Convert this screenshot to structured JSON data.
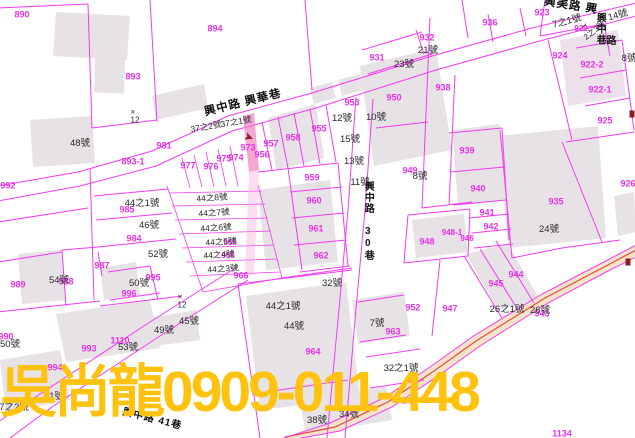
{
  "title": "cadastral-parcel-map",
  "colors": {
    "background": "#ffffff",
    "parcel_line": "#f23cf2",
    "building_fill": "#e7e2e6",
    "building_pink_fill": "#ece0ea",
    "road_fill_beige": "#f5e4c8",
    "road_centerline": "#e04b4b",
    "highlight_parcel": "#f07ec0",
    "pink_label": "#e832e8",
    "black_label": "#2a2a2a",
    "watermark_yellow": "#ffc20e",
    "marker_red": "#8f1d1d"
  },
  "watermark": {
    "text": "吳尚龍0909-011-448"
  },
  "map": {
    "road_names": [
      "興中路 興華巷",
      "興美路",
      "興中路 30巷",
      "興中路 41巷",
      "興中巷"
    ],
    "labels": [
      {
        "t": "890",
        "x": 22,
        "y": 15,
        "c": "pink"
      },
      {
        "t": "894",
        "x": 215,
        "y": 29,
        "c": "pink"
      },
      {
        "t": "893",
        "x": 133,
        "y": 77,
        "c": "pink"
      },
      {
        "t": "981",
        "x": 164,
        "y": 146,
        "c": "pink"
      },
      {
        "t": "893-1",
        "x": 133,
        "y": 162,
        "c": "pink"
      },
      {
        "t": "992",
        "x": 8,
        "y": 186,
        "c": "pink"
      },
      {
        "t": "977",
        "x": 188,
        "y": 166,
        "c": "pink"
      },
      {
        "t": "976",
        "x": 211,
        "y": 167,
        "c": "pink"
      },
      {
        "t": "975",
        "x": 224,
        "y": 159,
        "c": "pink"
      },
      {
        "t": "974",
        "x": 236,
        "y": 158,
        "c": "pink"
      },
      {
        "t": "973",
        "x": 248,
        "y": 148,
        "c": "pink"
      },
      {
        "t": "956",
        "x": 262,
        "y": 155,
        "c": "pink"
      },
      {
        "t": "957",
        "x": 271,
        "y": 144,
        "c": "pink"
      },
      {
        "t": "958",
        "x": 293,
        "y": 138,
        "c": "pink"
      },
      {
        "t": "955",
        "x": 319,
        "y": 129,
        "c": "pink"
      },
      {
        "t": "953",
        "x": 352,
        "y": 103,
        "c": "pink"
      },
      {
        "t": "959",
        "x": 312,
        "y": 178,
        "c": "pink"
      },
      {
        "t": "960",
        "x": 314,
        "y": 201,
        "c": "pink"
      },
      {
        "t": "961",
        "x": 316,
        "y": 229,
        "c": "pink"
      },
      {
        "t": "962",
        "x": 321,
        "y": 256,
        "c": "pink"
      },
      {
        "t": "966",
        "x": 241,
        "y": 276,
        "c": "pink"
      },
      {
        "t": "969",
        "x": 230,
        "y": 243,
        "c": "pink",
        "s": 8
      },
      {
        "t": "968",
        "x": 228,
        "y": 256,
        "c": "pink",
        "s": 8
      },
      {
        "t": "950",
        "x": 394,
        "y": 98,
        "c": "pink"
      },
      {
        "t": "938",
        "x": 443,
        "y": 88,
        "c": "pink"
      },
      {
        "t": "939",
        "x": 467,
        "y": 151,
        "c": "pink"
      },
      {
        "t": "949",
        "x": 410,
        "y": 171,
        "c": "pink"
      },
      {
        "t": "940",
        "x": 478,
        "y": 189,
        "c": "pink"
      },
      {
        "t": "941",
        "x": 487,
        "y": 213,
        "c": "pink"
      },
      {
        "t": "942",
        "x": 491,
        "y": 227,
        "c": "pink"
      },
      {
        "t": "948-1",
        "x": 452,
        "y": 233,
        "c": "pink",
        "s": 8
      },
      {
        "t": "946",
        "x": 467,
        "y": 239,
        "c": "pink",
        "s": 8
      },
      {
        "t": "948",
        "x": 427,
        "y": 242,
        "c": "pink"
      },
      {
        "t": "947",
        "x": 450,
        "y": 309,
        "c": "pink"
      },
      {
        "t": "945",
        "x": 496,
        "y": 284,
        "c": "pink"
      },
      {
        "t": "944",
        "x": 516,
        "y": 275,
        "c": "pink"
      },
      {
        "t": "943",
        "x": 542,
        "y": 314,
        "c": "pink"
      },
      {
        "t": "952",
        "x": 413,
        "y": 308,
        "c": "pink"
      },
      {
        "t": "963",
        "x": 393,
        "y": 332,
        "c": "pink"
      },
      {
        "t": "964",
        "x": 313,
        "y": 352,
        "c": "pink"
      },
      {
        "t": "935",
        "x": 556,
        "y": 202,
        "c": "pink"
      },
      {
        "t": "936",
        "x": 490,
        "y": 23,
        "c": "pink"
      },
      {
        "t": "932",
        "x": 427,
        "y": 38,
        "c": "pink"
      },
      {
        "t": "931",
        "x": 377,
        "y": 58,
        "c": "pink"
      },
      {
        "t": "923",
        "x": 542,
        "y": 13,
        "c": "pink"
      },
      {
        "t": "922",
        "x": 581,
        "y": 29,
        "c": "pink",
        "s": 8
      },
      {
        "t": "924",
        "x": 560,
        "y": 56,
        "c": "pink"
      },
      {
        "t": "922-2",
        "x": 592,
        "y": 65,
        "c": "pink"
      },
      {
        "t": "922-1",
        "x": 600,
        "y": 90,
        "c": "pink"
      },
      {
        "t": "925",
        "x": 605,
        "y": 121,
        "c": "pink"
      },
      {
        "t": "926",
        "x": 628,
        "y": 184,
        "c": "pink"
      },
      {
        "t": "984",
        "x": 134,
        "y": 239,
        "c": "pink"
      },
      {
        "t": "985",
        "x": 127,
        "y": 210,
        "c": "pink"
      },
      {
        "t": "987",
        "x": 102,
        "y": 266,
        "c": "pink"
      },
      {
        "t": "988",
        "x": 66,
        "y": 282,
        "c": "pink"
      },
      {
        "t": "989",
        "x": 18,
        "y": 285,
        "c": "pink"
      },
      {
        "t": "990",
        "x": 6,
        "y": 337,
        "c": "pink"
      },
      {
        "t": "993",
        "x": 89,
        "y": 349,
        "c": "pink"
      },
      {
        "t": "994",
        "x": 55,
        "y": 368,
        "c": "pink"
      },
      {
        "t": "995",
        "x": 153,
        "y": 278,
        "c": "pink"
      },
      {
        "t": "996",
        "x": 129,
        "y": 294,
        "c": "pink"
      },
      {
        "t": "1110",
        "x": 120,
        "y": 341,
        "c": "pink"
      },
      {
        "t": "1134",
        "x": 562,
        "y": 434,
        "c": "pink"
      },
      {
        "t": "24",
        "x": 407,
        "y": 401,
        "c": "pink"
      },
      {
        "t": "48號",
        "x": 80,
        "y": 144,
        "c": "blk"
      },
      {
        "t": "×\n12",
        "x": 135,
        "y": 117,
        "c": "blk",
        "s": 8
      },
      {
        "t": "×\n12",
        "x": 182,
        "y": 302,
        "c": "blk",
        "s": 8
      },
      {
        "t": "37之2號",
        "x": 206,
        "y": 127,
        "c": "blk",
        "r": -10,
        "s": 8.5
      },
      {
        "t": "37之1號",
        "x": 236,
        "y": 122,
        "c": "blk",
        "r": -10,
        "s": 8.5
      },
      {
        "t": "21號",
        "x": 428,
        "y": 51,
        "c": "blk"
      },
      {
        "t": "23號",
        "x": 404,
        "y": 65,
        "c": "blk"
      },
      {
        "t": "7之1號",
        "x": 567,
        "y": 22,
        "c": "blk",
        "r": -15
      },
      {
        "t": "~",
        "x": 584,
        "y": 26,
        "c": "blk",
        "r": -50,
        "s": 12
      },
      {
        "t": "14號",
        "x": 618,
        "y": 16,
        "c": "blk",
        "r": -15
      },
      {
        "t": "2之3號",
        "x": 595,
        "y": 31,
        "c": "blk",
        "r": -38,
        "s": 8
      },
      {
        "t": "8號",
        "x": 629,
        "y": 59,
        "c": "blk"
      },
      {
        "t": "12號",
        "x": 342,
        "y": 119,
        "c": "blk"
      },
      {
        "t": "10號",
        "x": 376,
        "y": 118,
        "c": "blk"
      },
      {
        "t": "15號",
        "x": 350,
        "y": 140,
        "c": "blk"
      },
      {
        "t": "13號",
        "x": 354,
        "y": 162,
        "c": "blk"
      },
      {
        "t": "11號",
        "x": 360,
        "y": 183,
        "c": "blk"
      },
      {
        "t": "8號",
        "x": 420,
        "y": 177,
        "c": "blk"
      },
      {
        "t": "24號",
        "x": 549,
        "y": 230,
        "c": "blk"
      },
      {
        "t": "44之8號",
        "x": 212,
        "y": 198,
        "c": "blk",
        "r": -4,
        "s": 8.5
      },
      {
        "t": "44之7號",
        "x": 214,
        "y": 213,
        "c": "blk",
        "r": -4,
        "s": 8.5
      },
      {
        "t": "44之6號",
        "x": 216,
        "y": 228,
        "c": "blk",
        "r": -4,
        "s": 8.5
      },
      {
        "t": "44之5號",
        "x": 221,
        "y": 242,
        "c": "blk",
        "r": -4,
        "s": 8.5
      },
      {
        "t": "44之4號",
        "x": 219,
        "y": 255,
        "c": "blk",
        "r": -4,
        "s": 8.5
      },
      {
        "t": "44之3號",
        "x": 223,
        "y": 269,
        "c": "blk",
        "r": -4,
        "s": 8.5
      },
      {
        "t": "44之1號",
        "x": 142,
        "y": 204,
        "c": "blk"
      },
      {
        "t": "46號",
        "x": 149,
        "y": 226,
        "c": "blk"
      },
      {
        "t": "52號",
        "x": 158,
        "y": 255,
        "c": "blk"
      },
      {
        "t": "54號",
        "x": 59,
        "y": 281,
        "c": "blk"
      },
      {
        "t": "50號",
        "x": 139,
        "y": 284,
        "c": "blk"
      },
      {
        "t": "50號",
        "x": 10,
        "y": 345,
        "c": "blk"
      },
      {
        "t": "53號",
        "x": 128,
        "y": 348,
        "c": "blk"
      },
      {
        "t": "49號",
        "x": 164,
        "y": 331,
        "c": "blk"
      },
      {
        "t": "45號",
        "x": 189,
        "y": 322,
        "c": "blk"
      },
      {
        "t": "51號",
        "x": 54,
        "y": 397,
        "c": "blk"
      },
      {
        "t": "7之2號",
        "x": 14,
        "y": 408,
        "c": "blk"
      },
      {
        "t": "44之1號",
        "x": 283,
        "y": 307,
        "c": "blk"
      },
      {
        "t": "44號",
        "x": 294,
        "y": 327,
        "c": "blk"
      },
      {
        "t": "32號",
        "x": 332,
        "y": 284,
        "c": "blk"
      },
      {
        "t": "7號",
        "x": 377,
        "y": 324,
        "c": "blk"
      },
      {
        "t": "32之1號",
        "x": 401,
        "y": 369,
        "c": "blk"
      },
      {
        "t": "38號",
        "x": 317,
        "y": 421,
        "c": "blk"
      },
      {
        "t": "34號",
        "x": 349,
        "y": 415,
        "c": "blk"
      },
      {
        "t": "26之1號",
        "x": 507,
        "y": 310,
        "c": "blk"
      },
      {
        "t": "26號",
        "x": 540,
        "y": 311,
        "c": "blk"
      },
      {
        "t": "興中路 興華巷",
        "x": 243,
        "y": 103,
        "c": "road",
        "r": -14
      },
      {
        "t": "興美路 興",
        "x": 571,
        "y": 6,
        "c": "road",
        "r": 9
      },
      {
        "t": "興中巷",
        "x": 599,
        "y": 29,
        "c": "road",
        "v": 1,
        "s": 10
      },
      {
        "t": "路",
        "x": 612,
        "y": 42,
        "c": "road",
        "s": 10
      },
      {
        "t": "興中路 30巷",
        "x": 367,
        "y": 221,
        "c": "road",
        "v": 1,
        "s": 10
      },
      {
        "t": "興中路 41巷",
        "x": 152,
        "y": 420,
        "c": "road",
        "r": 14,
        "s": 10
      }
    ],
    "markers": [
      {
        "type": "arrow",
        "x": 249,
        "y": 137,
        "r": 20,
        "glyph": "➤"
      },
      {
        "type": "dot",
        "x": 628,
        "y": 262
      },
      {
        "type": "dot",
        "x": 632,
        "y": 114
      }
    ]
  }
}
